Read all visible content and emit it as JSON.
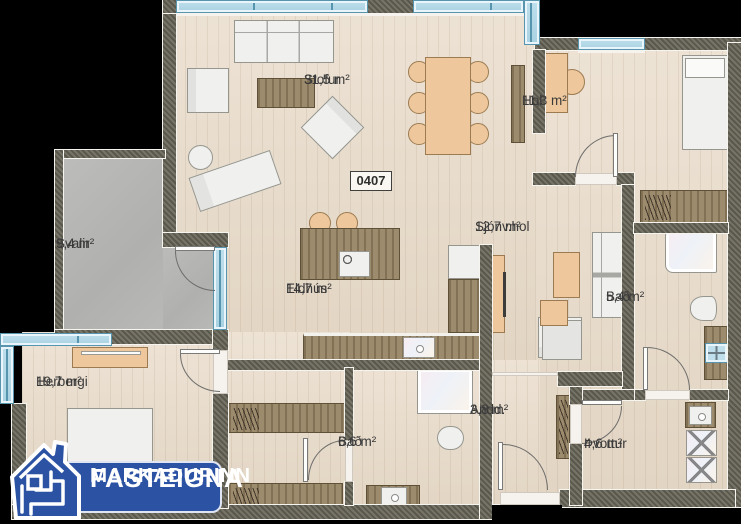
{
  "unit_number": "0407",
  "logo": {
    "line1": "FASTEIGNA",
    "line2": "MARKAÐURINN"
  },
  "rooms": {
    "stofur": {
      "name": "Stofur",
      "area": "31,5 m²"
    },
    "hol": {
      "name": "Hol",
      "area": "11,3 m²"
    },
    "svalir": {
      "name": "Svalir",
      "area": "9,4 m²"
    },
    "eldhus": {
      "name": "Eldhús",
      "area": "14,7 m²"
    },
    "sjonvhol": {
      "name": "Sjónv.hol",
      "area": "12,7 m²"
    },
    "bad_small": {
      "name": "Bað",
      "area": "5,4 m²"
    },
    "herbergi": {
      "name": "Herbergi",
      "area": "19,7 m²"
    },
    "bad_large": {
      "name": "Bað",
      "area": "6,6 m²"
    },
    "andd": {
      "name": "Andd.",
      "area": "3,8 m²"
    },
    "thvottur": {
      "name": "Þvottur",
      "area": "4,6 m²"
    }
  },
  "colors": {
    "logo_blue": "#2b52a3",
    "wall": "#6e6a5e",
    "floor_wood": "#e9dccb",
    "window_blue": "#bfdfec",
    "balcony_concrete": "#b5b5b3",
    "furniture_wood": "#948161",
    "furniture_tan": "#eec89c"
  }
}
